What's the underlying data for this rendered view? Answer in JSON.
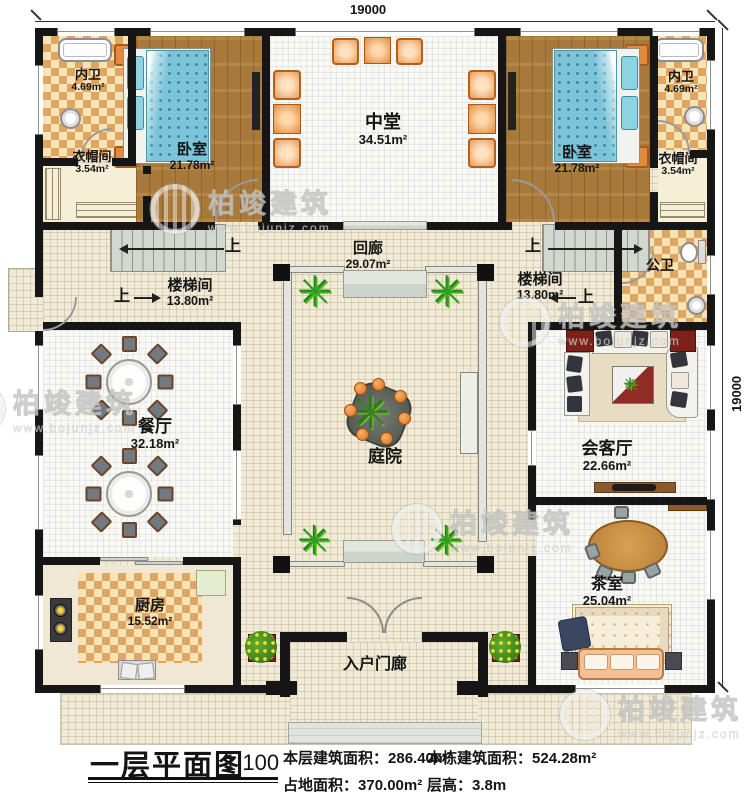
{
  "plan": {
    "rooms": {
      "neiwei_l": {
        "name": "内卫",
        "area": "4.69m²"
      },
      "yimaojian_l": {
        "name": "衣帽间",
        "area": "3.54m²"
      },
      "woshi_l": {
        "name": "卧室",
        "area": "21.78m²"
      },
      "zhongtang": {
        "name": "中堂",
        "area": "34.51m²"
      },
      "woshi_r": {
        "name": "卧室",
        "area": "21.78m²"
      },
      "neiwei_r": {
        "name": "内卫",
        "area": "4.69m²"
      },
      "yimaojian_r": {
        "name": "衣帽间",
        "area": "3.54m²"
      },
      "huilang": {
        "name": "回廊",
        "area": "29.07m²"
      },
      "louti_l": {
        "name": "楼梯间",
        "area": "13.80m²"
      },
      "louti_r": {
        "name": "楼梯间",
        "area": "13.80m²"
      },
      "gongwei": {
        "name": "公卫"
      },
      "canting": {
        "name": "餐厅",
        "area": "32.18m²"
      },
      "tingyuan": {
        "name": "庭院"
      },
      "huiketing": {
        "name": "会客厅",
        "area": "22.66m²"
      },
      "chashi": {
        "name": "茶室",
        "area": "25.04m²"
      },
      "chufang": {
        "name": "厨房",
        "area": "15.52m²"
      },
      "rumenlan": {
        "name": "入户门廊"
      }
    },
    "stairs": {
      "up": "上"
    },
    "dimensions": {
      "width": "19000",
      "height": "19000"
    }
  },
  "title_block": {
    "title": "一层平面图",
    "scale": "1:100",
    "stats": {
      "floor_area_label": "本层建筑面积：",
      "floor_area": "286.40m²",
      "footprint_label": "占地面积：",
      "footprint": "370.00m²",
      "total_area_label": "本栋建筑面积：",
      "total_area": "524.28m²",
      "story_height_label": "层高：",
      "story_height": "3.8m"
    }
  },
  "watermark": {
    "brand": "柏竣建筑",
    "site": "www.bojunjz.com"
  },
  "colors": {
    "wall": "#161616",
    "wood": "#b0803e",
    "checker": "#dfa562",
    "accent_green": "#2f9e23"
  }
}
